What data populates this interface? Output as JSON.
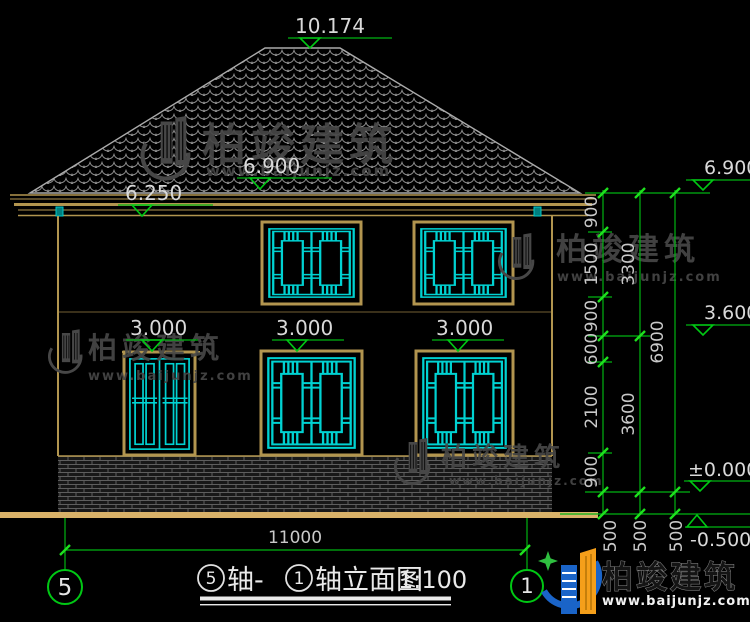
{
  "watermark": {
    "brand": "柏竣建筑",
    "url": "www.baijunjz.com"
  },
  "logo": {
    "brand": "柏竣建筑",
    "url": "www.baijunjz.com"
  },
  "elevations": {
    "ridge": "10.174",
    "roof_eave": "6.900",
    "eave_bottom": "6.250",
    "right_eave": "6.900",
    "right_floor2": "3.600",
    "right_zero": "±0.000",
    "right_ground": "-0.500",
    "lintel_left": "3.000",
    "lintel_mid": "3.000",
    "lintel_right": "3.000"
  },
  "dims": {
    "chain1": [
      "900",
      "1500",
      "900",
      "600",
      "2100",
      "900"
    ],
    "chain2": [
      "3300",
      "3600"
    ],
    "chain3": [
      "6900"
    ],
    "plinth": [
      "500",
      "500",
      "500"
    ],
    "width": "11000"
  },
  "axes": {
    "left": "5",
    "right": "1"
  },
  "title": {
    "axis_left": "5",
    "mid": "轴-",
    "axis_right": "1",
    "suffix": "轴立面图",
    "scale": "1:100"
  },
  "colors": {
    "dim_green": "#00b412",
    "window_cyan": "#00d2d2",
    "frame_tan": "#b2954f",
    "logo_blue": "#1a64c8",
    "logo_orange": "#f59f1a"
  }
}
